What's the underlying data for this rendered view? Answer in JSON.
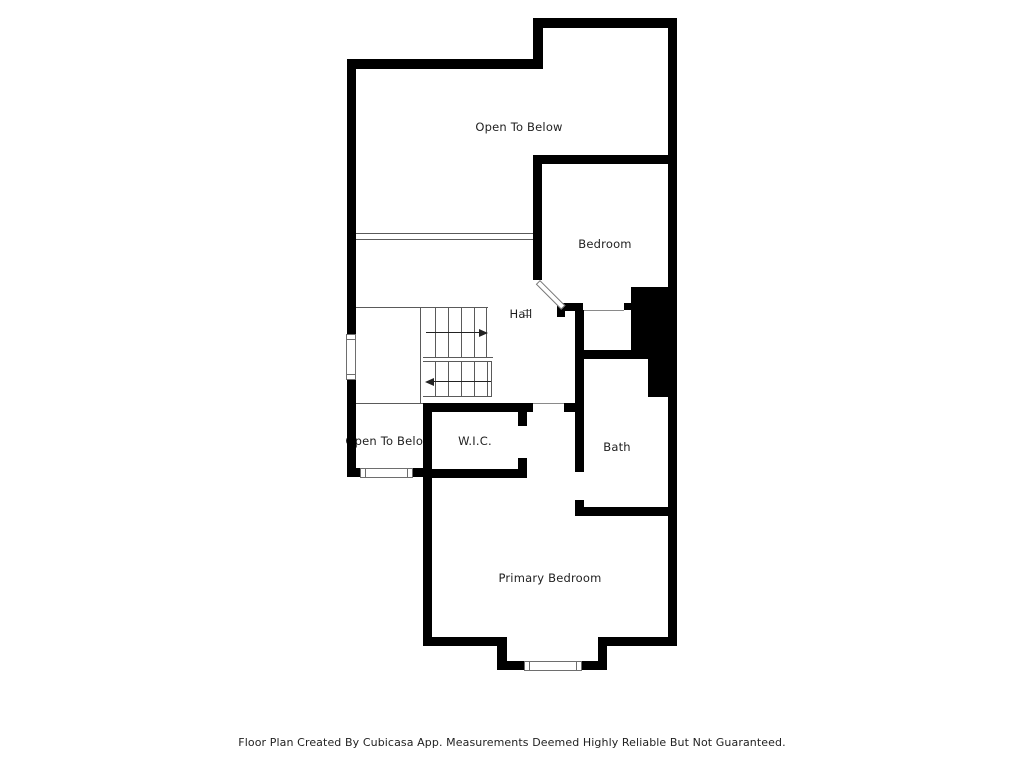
{
  "floor_plan": {
    "rooms": {
      "open_to_below_top": "Open To Below",
      "bedroom": "Bedroom",
      "hall": "Hall",
      "open_to_below_small": "Open To Below",
      "wic": "W.I.C.",
      "bath": "Bath",
      "primary_bedroom": "Primary Bedroom"
    },
    "symbols": {
      "stair_up_arrow": "stair-direction-arrow-right",
      "stair_down_arrow": "stair-direction-arrow-left",
      "door": "bedroom-door-swing",
      "windows": [
        "left-wall-window",
        "lower-left-window",
        "primary-bedroom-window"
      ]
    },
    "colors": {
      "wall": "#000000",
      "thin_line": "#5a5a5a",
      "text": "#1f1f1f",
      "background": "#ffffff"
    },
    "footer": "Floor Plan Created By Cubicasa App. Measurements Deemed Highly Reliable But Not Guaranteed."
  }
}
